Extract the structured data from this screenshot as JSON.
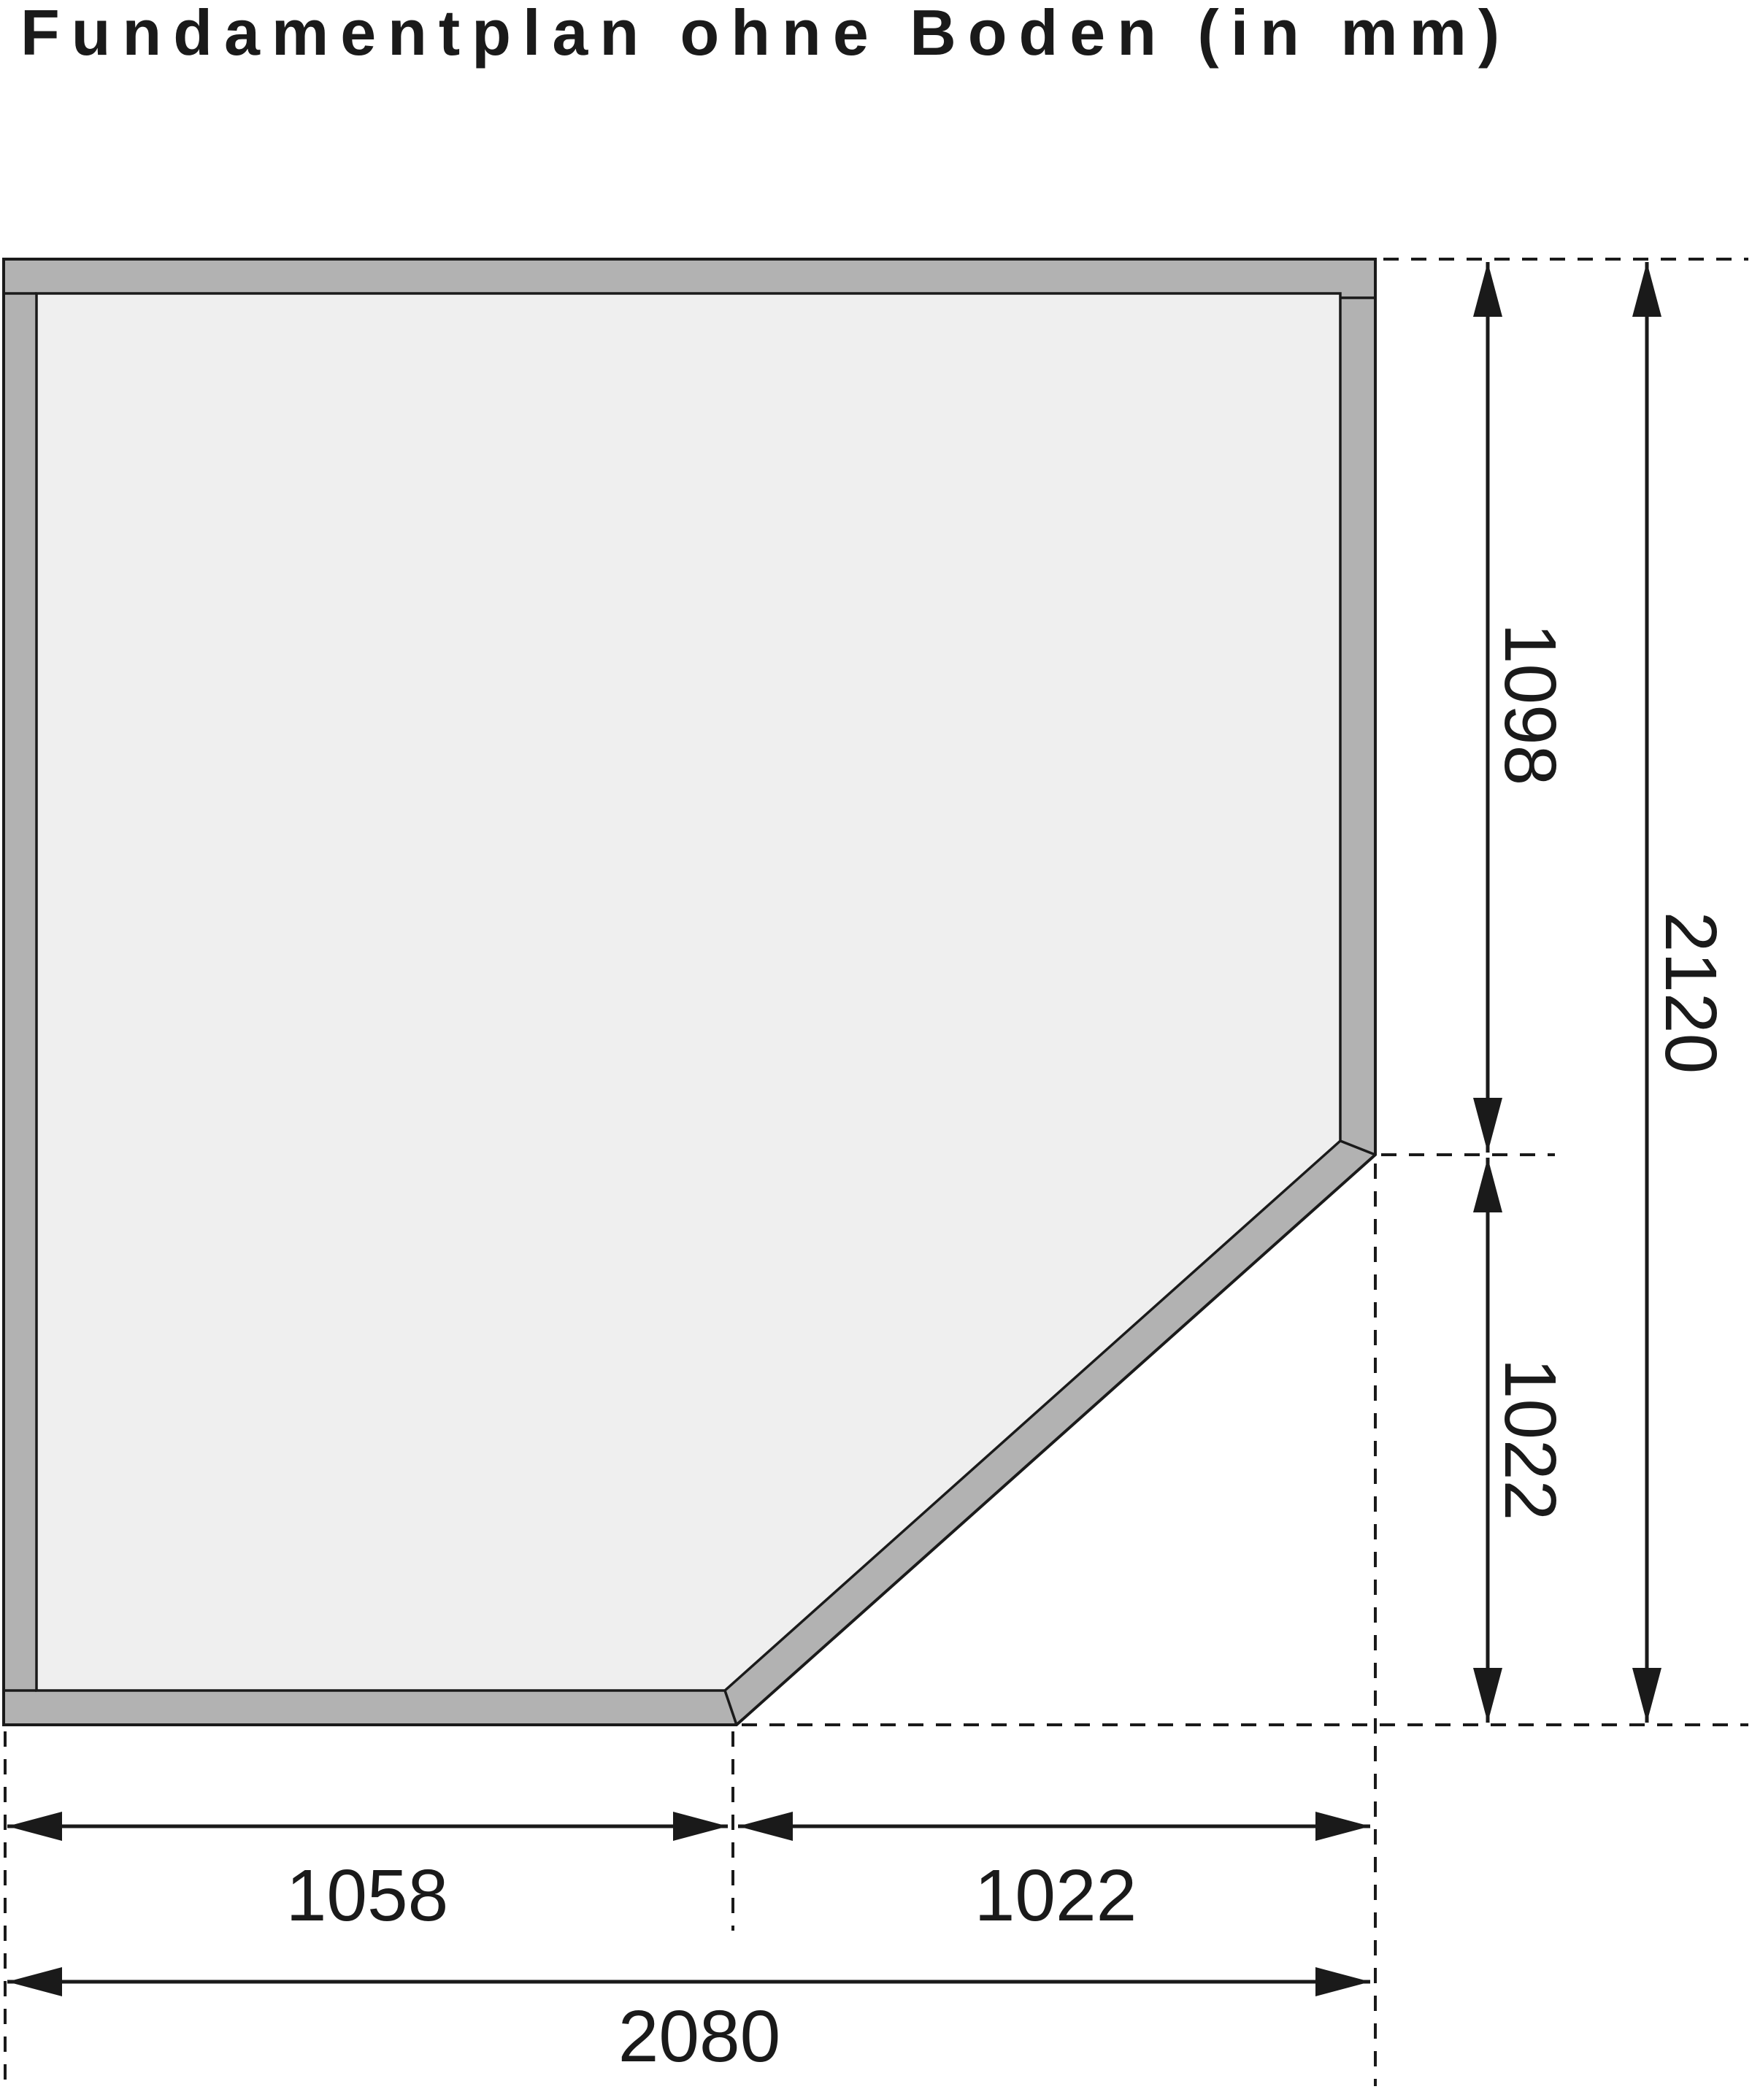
{
  "title": "Fundamentplan ohne Boden (in mm)",
  "unit": "mm",
  "colors": {
    "background": "#ffffff",
    "wall_fill": "#b2b2b2",
    "interior_fill": "#efefef",
    "line": "#1a1a1a"
  },
  "plan": {
    "shape": "square plan with beveled (45°) bottom-right corner, walls shown as gray band",
    "right_dimensions": {
      "upper": "1098",
      "lower": "1022",
      "total": "2120"
    },
    "bottom_dimensions": {
      "left": "1058",
      "right": "1022",
      "total": "2080"
    }
  }
}
